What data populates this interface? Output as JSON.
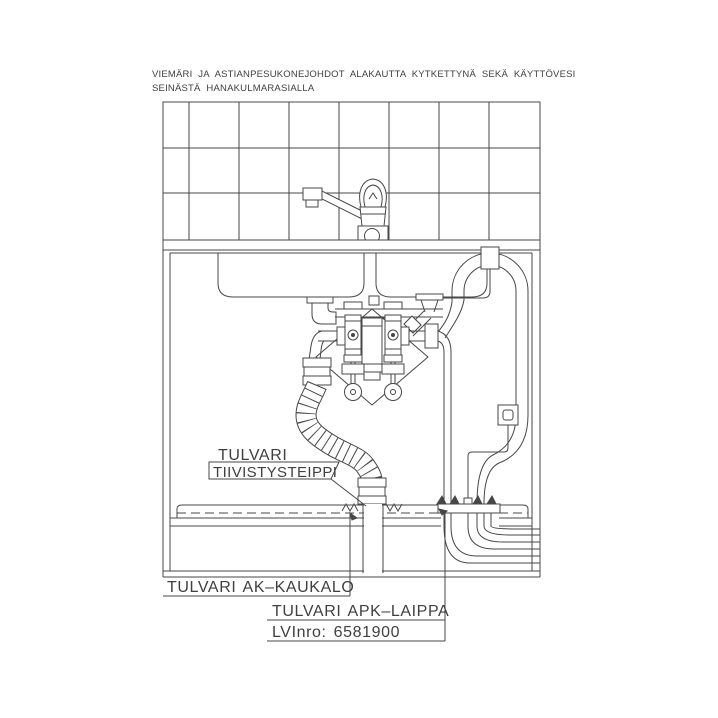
{
  "title": {
    "line1": "VIEMÄRI JA ASTIANPESUKONEJOHDOT ALAKAUTTA KYTKETTYNÄ SEKÄ KÄYTTÖVESI",
    "line2": "SEINÄSTÄ HANAKULMARASIALLA"
  },
  "callouts": {
    "hose_seal_line1": "TULVARI",
    "hose_seal_line2": "TIIVISTYSTEIPPI",
    "drip_tray": "TULVARI AK–KAUKALO",
    "dishwasher_flange": "TULVARI APK–LAIPPA",
    "lvi_number": "LVInro: 6581900"
  },
  "drawing": {
    "ink_color": "#474747",
    "background_color": "#ffffff"
  }
}
